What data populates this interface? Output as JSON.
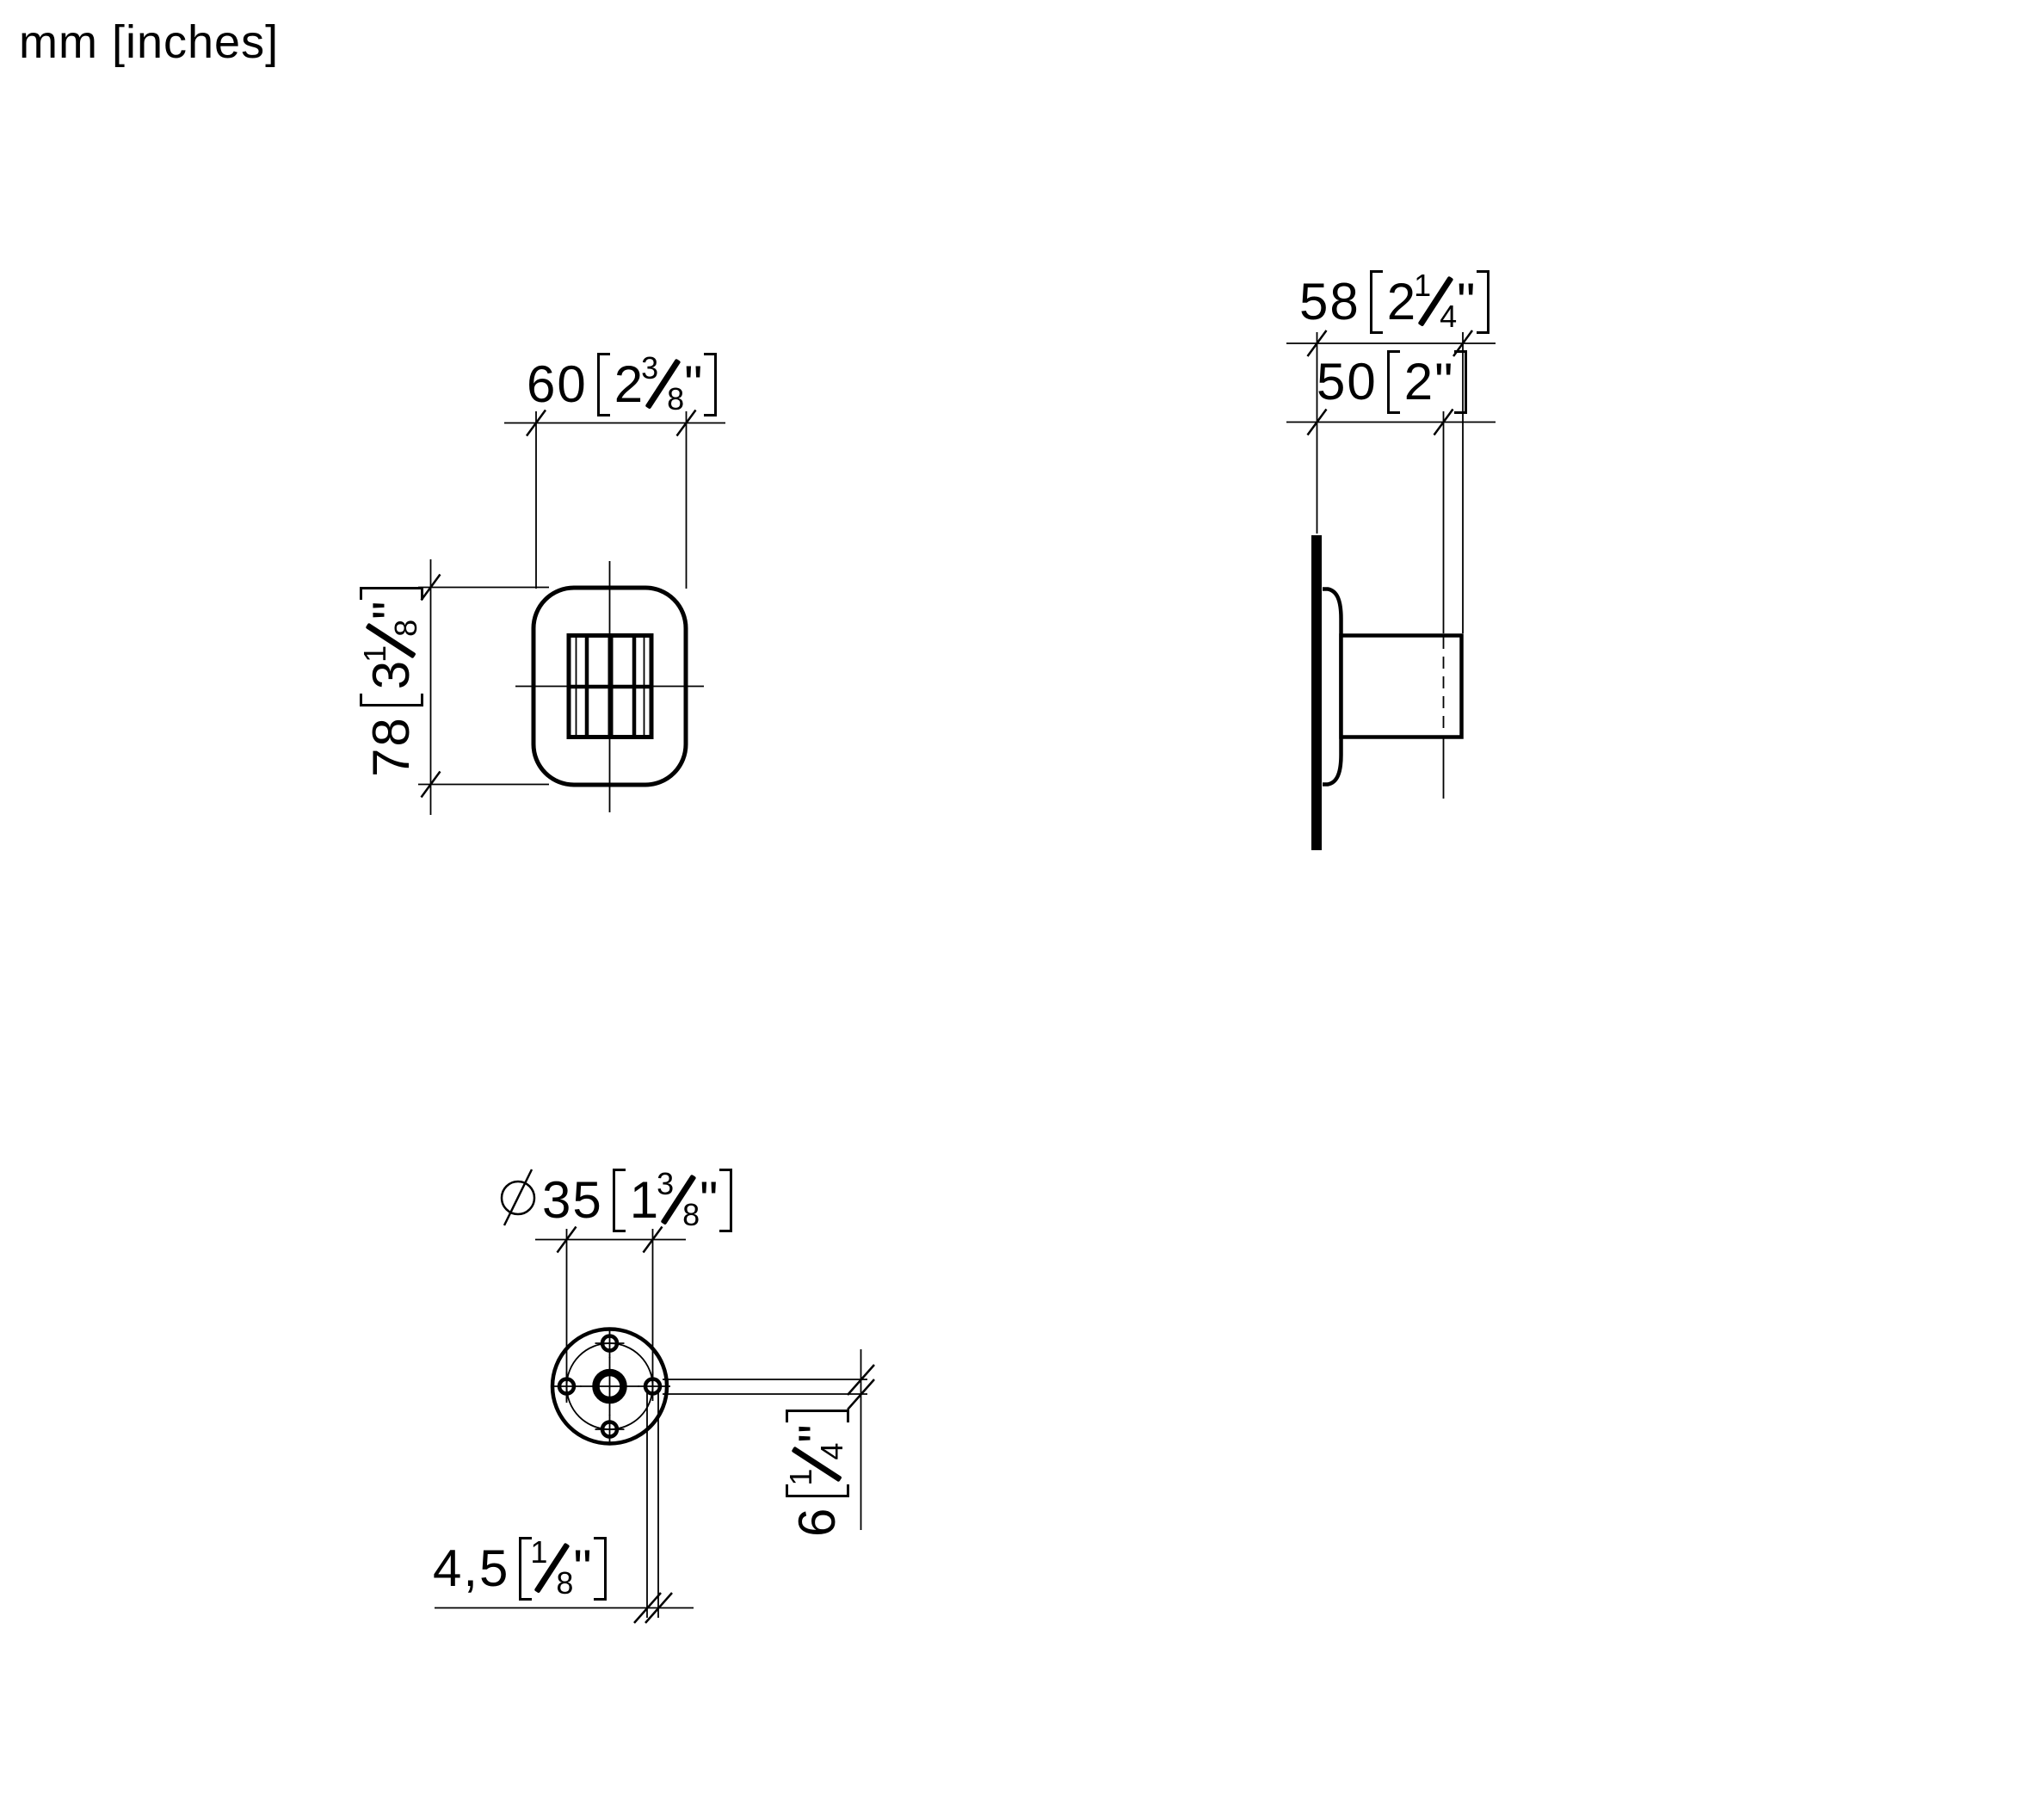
{
  "page": {
    "unit_note": "mm [inches]",
    "line_color": "#000000",
    "background": "#ffffff"
  },
  "dims": {
    "front_width": {
      "mm": "60",
      "inch_whole": "2",
      "inch_num": "3",
      "inch_den": "8",
      "inch_mark": "\""
    },
    "front_height": {
      "mm": "78",
      "inch_whole": "3",
      "inch_num": "1",
      "inch_den": "8",
      "inch_mark": "\""
    },
    "side_depth": {
      "mm": "58",
      "inch_whole": "2",
      "inch_num": "1",
      "inch_den": "4",
      "inch_mark": "\""
    },
    "side_body": {
      "mm": "50",
      "inch_whole": "2",
      "inch_mark": "\""
    },
    "bottom_flange": {
      "symbol": "Ø",
      "mm": "35",
      "inch_whole": "1",
      "inch_num": "3",
      "inch_den": "8",
      "inch_mark": "\""
    },
    "bottom_hole": {
      "mm": "6",
      "inch_num": "1",
      "inch_den": "4",
      "inch_mark": "\""
    },
    "bottom_screw": {
      "mm": "4,5",
      "inch_num": "1",
      "inch_den": "8",
      "inch_mark": "\""
    }
  }
}
